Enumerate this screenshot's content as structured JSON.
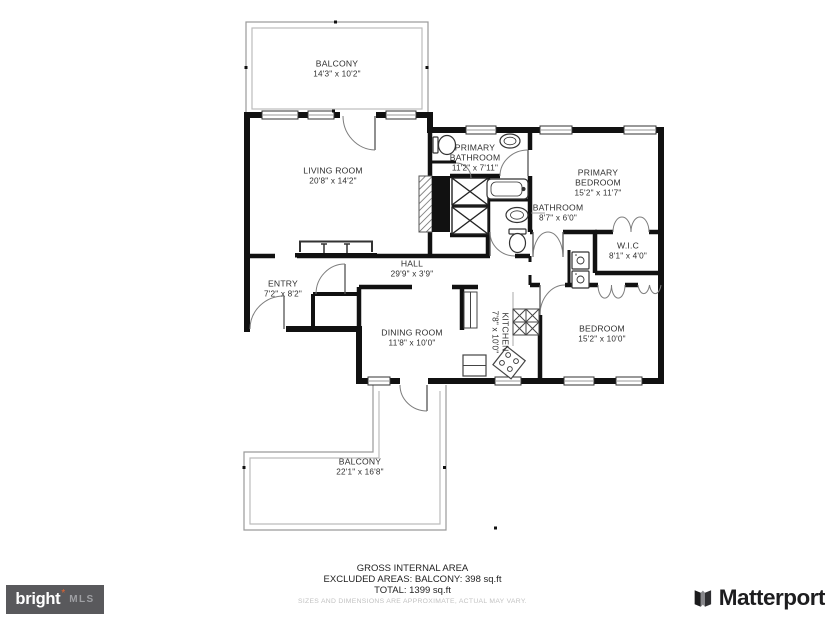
{
  "rooms": {
    "balcony_upper": {
      "name": "BALCONY",
      "dims": "14'3\" x 10'2\""
    },
    "living_room": {
      "name": "LIVING ROOM",
      "dims": "20'8\" x 14'2\""
    },
    "primary_bathroom": {
      "name": "PRIMARY\nBATHROOM",
      "dims": "11'2\" x 7'11\""
    },
    "primary_bedroom": {
      "name": "PRIMARY\nBEDROOM",
      "dims": "15'2\" x 11'7\""
    },
    "bathroom": {
      "name": "BATHROOM",
      "dims": "8'7\" x 6'0\""
    },
    "wic": {
      "name": "W.I.C",
      "dims": "8'1\" x 4'0\""
    },
    "hall": {
      "name": "HALL",
      "dims": "29'9\" x 3'9\""
    },
    "entry": {
      "name": "ENTRY",
      "dims": "7'2\" x 8'2\""
    },
    "dining_room": {
      "name": "DINING ROOM",
      "dims": "11'8\" x 10'0\""
    },
    "kitchen": {
      "name": "KITCHEN",
      "dims": "7'8\" x 10'0\""
    },
    "bedroom": {
      "name": "BEDROOM",
      "dims": "15'2\" x 10'0\""
    },
    "balcony_lower": {
      "name": "BALCONY",
      "dims": "22'1\" x 16'8\""
    }
  },
  "footer": {
    "gross_area_label": "GROSS INTERNAL AREA",
    "excluded_areas": "EXCLUDED AREAS: BALCONY: 398 sq.ft",
    "total": "TOTAL: 1399 sq.ft",
    "disclaimer": "SIZES AND DIMENSIONS ARE APPROXIMATE, ACTUAL MAY VARY."
  },
  "branding": {
    "bright_mls": {
      "wordmark": "bright",
      "star": "*",
      "suffix": "MLS",
      "bg_color": "#59595c",
      "star_color": "#e8622d"
    },
    "matterport": {
      "wordmark": "Matterport"
    }
  },
  "colors": {
    "wall": "#111111",
    "label_text": "#2f2f2f",
    "thin_line": "#8a8a8a",
    "railing": "#9a9a9a",
    "disclaimer_text": "#c2c2c2"
  },
  "icons": {
    "fixtures": [
      "door-arc",
      "window",
      "bifold-door",
      "toilet",
      "sink",
      "bathtub",
      "cooktop",
      "stove",
      "refrigerator",
      "washer",
      "dryer",
      "sofa",
      "closet-x",
      "fireplace",
      "chimney",
      "pantry-shelves"
    ]
  }
}
